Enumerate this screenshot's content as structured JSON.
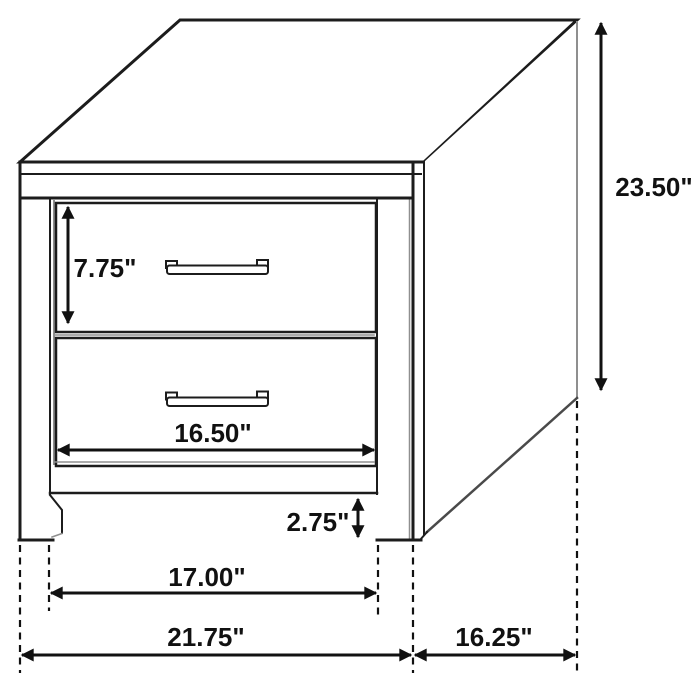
{
  "diagram": {
    "kind": "furniture-dimension-drawing",
    "units": "inches",
    "labels": {
      "overall_height": "23.50\"",
      "drawer_face_height": "7.75\"",
      "drawer_width": "16.50\"",
      "floor_clearance": "2.75\"",
      "inner_leg_width": "17.00\"",
      "overall_width": "21.75\"",
      "depth": "16.25\""
    },
    "colors": {
      "line": "#1c1c1c",
      "soft_line": "#8f8f8f",
      "dimension": "#111111",
      "background": "#ffffff"
    }
  }
}
